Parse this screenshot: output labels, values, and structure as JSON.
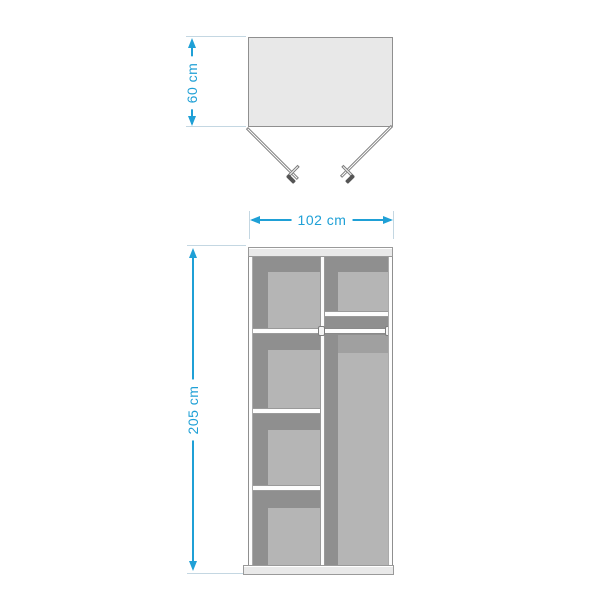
{
  "diagram": {
    "dimensions": {
      "depth": "60 cm",
      "width": "102 cm",
      "height": "205 cm"
    },
    "colors": {
      "dimension_accent": "#1fa0d6",
      "extension_line": "#c4d7e2",
      "interior_shadow": "#8f8f8f",
      "back_panel": "#b5b5b5",
      "panel_fill": "#e9e9e9",
      "outline": "#9a9a9a"
    }
  }
}
